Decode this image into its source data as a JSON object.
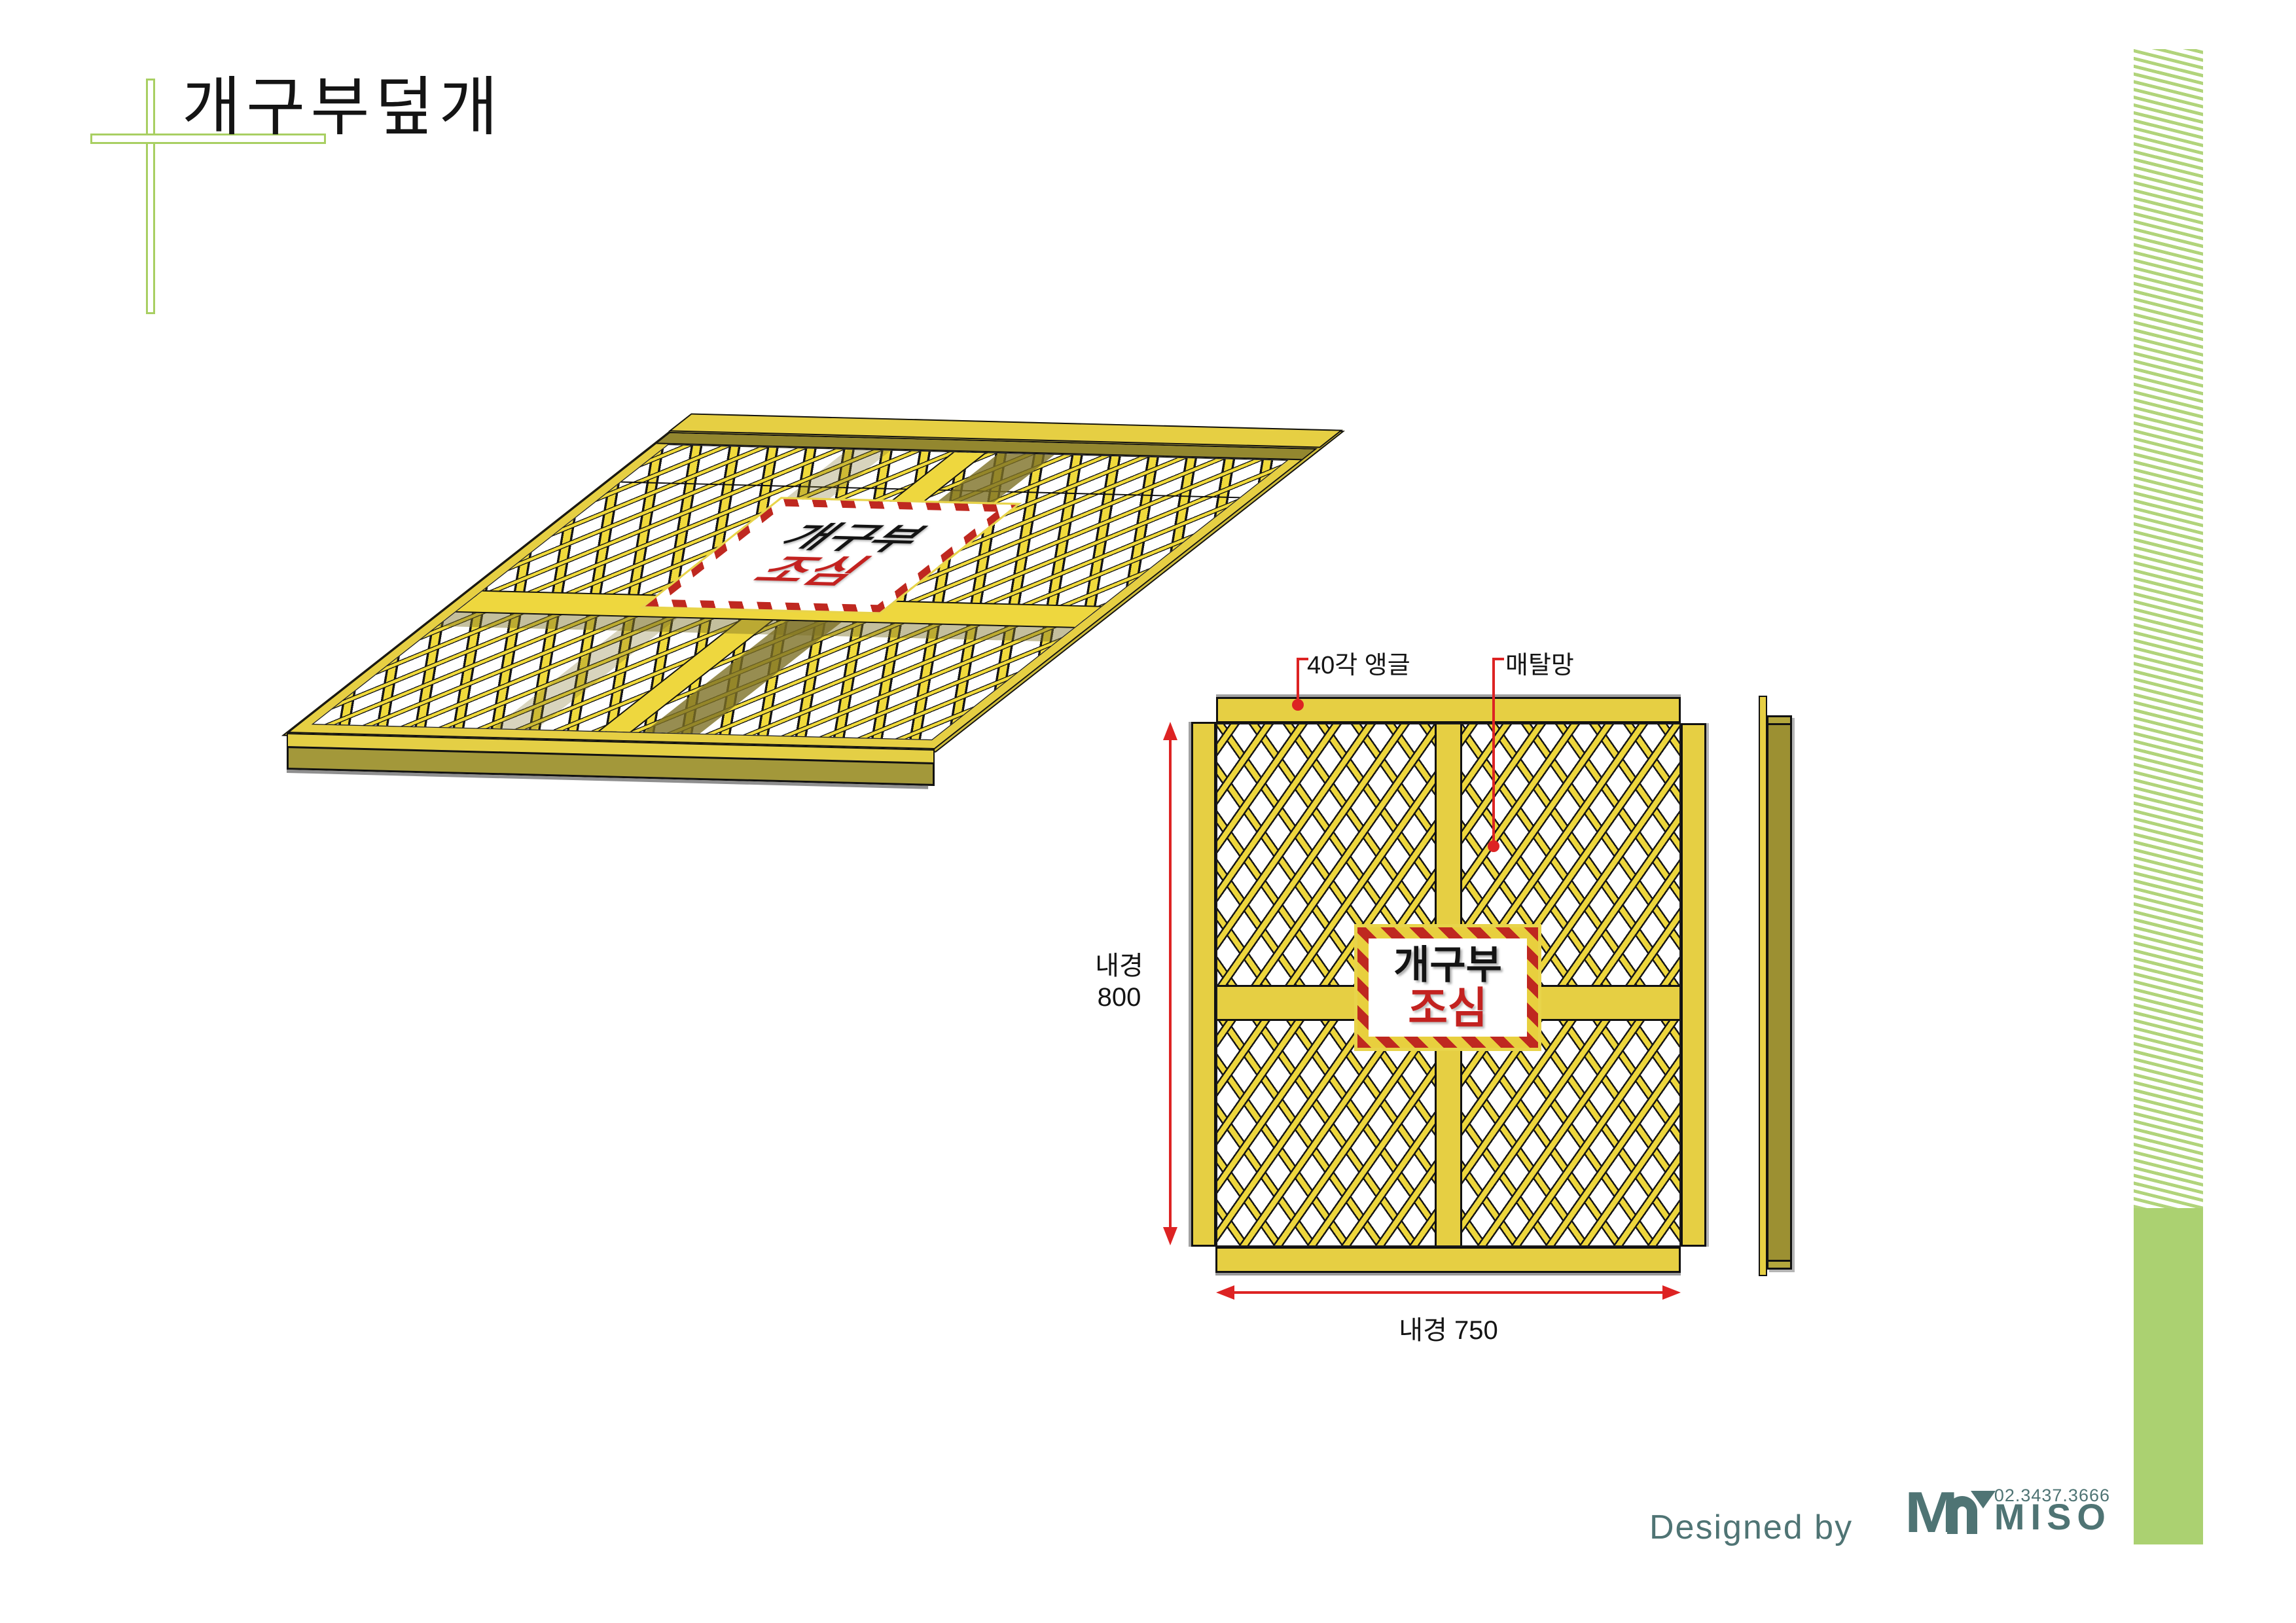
{
  "title": "개구부덮개",
  "sign": {
    "line1": "개구부",
    "line2": "조심"
  },
  "front_view": {
    "angle_label": "40각 앵글",
    "mesh_label": "매탈망",
    "dim_vertical_label": "내경",
    "dim_vertical_value": "800",
    "dim_horizontal": "내경 750"
  },
  "logo": {
    "designed_by": "Designed by",
    "brand_m": "M",
    "brand_name": "MISO",
    "phone": "02.3437.3666"
  },
  "colors": {
    "frame_yellow": "#e6cf43",
    "mesh_strand_yellow": "#edd63c",
    "olive_dark_yellow": "#9c9032",
    "base_sheet_olive": "#cdbb3a",
    "sign_red": "#bf2820",
    "dimension_red": "#dd2323",
    "logo_teal": "#4f7474",
    "accent_green_solid": "#abd171",
    "accent_green_stripe": "#b1d47b",
    "cross_green": "#a8cf62",
    "outline_black": "#111111"
  }
}
